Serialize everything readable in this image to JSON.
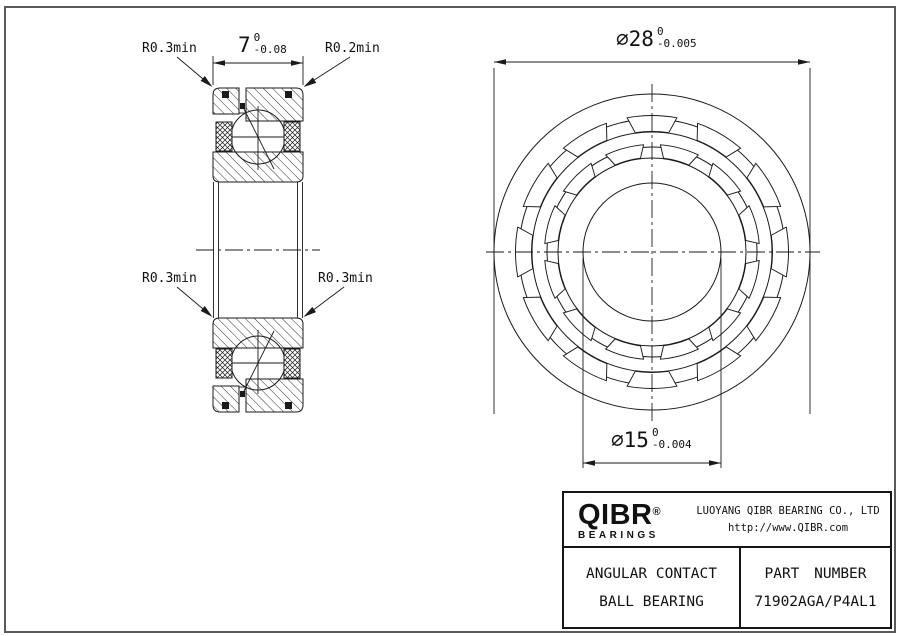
{
  "drawing": {
    "line_color": "#1a1a1a",
    "frame_color": "#5a5a5a"
  },
  "section_view": {
    "width_dim": {
      "label": "7",
      "tol_upper": "0",
      "tol_lower": "-0.08"
    },
    "radius_labels": {
      "top_left": "R0.3min",
      "top_right": "R0.2min",
      "mid_left": "R0.3min",
      "mid_right": "R0.3min"
    }
  },
  "front_view": {
    "outer_dim": {
      "label": "⌀28",
      "tol_upper": "0",
      "tol_lower": "-0.005"
    },
    "bore_dim": {
      "label": "⌀15",
      "tol_upper": "0",
      "tol_lower": "-0.004"
    }
  },
  "title_block": {
    "logo_text": "QIBR",
    "logo_registered": "®",
    "logo_subtext": "BEARINGS",
    "company_name": "LUOYANG QIBR BEARING CO., LTD",
    "website": "http://www.QIBR.com",
    "product_type_line1": "ANGULAR CONTACT",
    "product_type_line2": "BALL BEARING",
    "part_number_label": "PART NUMBER",
    "part_number": "71902AGA/P4AL1"
  }
}
